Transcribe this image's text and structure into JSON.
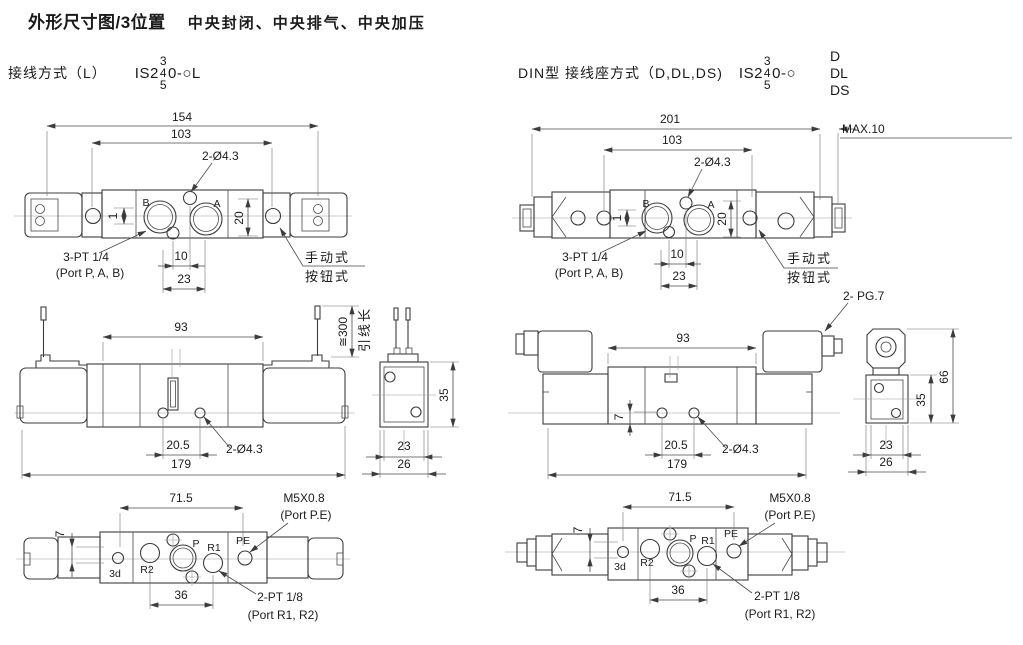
{
  "header": {
    "title": "外形尺寸图/3位置",
    "subtitle": "中央封闭、中央排气、中央加压"
  },
  "variant_left": {
    "label": "接线方式（L）",
    "model_prefix": "IS2",
    "stack_top": "3",
    "stack_mid": "4",
    "stack_bottom": "5",
    "model_suffix": "0-○L"
  },
  "variant_right": {
    "label": "DIN型 接线座方式（D,DL,DS)",
    "model_prefix": "IS2",
    "stack_top": "3",
    "stack_mid": "4",
    "stack_bottom": "5",
    "model_suffix": "0-○",
    "option_top": "D",
    "option_mid": "DL",
    "option_bottom": "DS"
  },
  "top_left": {
    "dim_overall": "154",
    "dim_mount": "103",
    "hole_note": "2-Ø4.3",
    "port_b": "B",
    "port_a": "A",
    "dim_height": "20",
    "dim_offset": "1",
    "dim_hole_pitch": "10",
    "dim_port_pitch": "23",
    "thread_note": "3-PT 1/4",
    "thread_ports": "(Port P, A, B)",
    "manual_line1": "手动式",
    "manual_line2": "按钮式"
  },
  "top_right": {
    "dim_overall": "201",
    "dim_max": "MAX.10",
    "dim_mount": "103",
    "hole_note": "2-Ø4.3",
    "port_b": "B",
    "port_a": "A",
    "dim_height": "20",
    "dim_offset": "1",
    "dim_hole_pitch": "10",
    "dim_port_pitch": "23",
    "thread_note": "3-PT 1/4",
    "thread_ports": "(Port P, A, B)",
    "manual_line1": "手动式",
    "manual_line2": "按钮式"
  },
  "mid_left": {
    "dim_body": "93",
    "wire_length": "≅300",
    "wire_label": "引线长",
    "dim_hole_pitch": "20.5",
    "hole_note": "2-Ø4.3",
    "dim_overall": "179",
    "side": {
      "dim_height": "35",
      "dim_inner_width": "23",
      "dim_width": "26"
    }
  },
  "mid_right": {
    "pg_note": "2- PG.7",
    "dim_body": "93",
    "dim_offset": "7",
    "dim_hole_pitch": "20.5",
    "hole_note": "2-Ø4.3",
    "dim_overall": "179",
    "side": {
      "dim_total_height": "66",
      "dim_height": "35",
      "dim_inner_width": "23",
      "dim_width": "26"
    }
  },
  "bottom_left": {
    "dim_pe_pitch": "71.5",
    "pe_thread": "M5X0.8",
    "pe_port": "(Port P.E)",
    "dim_offset": "7",
    "label_3d": "3d",
    "label_r2": "R2",
    "label_p": "P",
    "label_r1": "R1",
    "label_pe": "PE",
    "dim_exhaust_pitch": "36",
    "exhaust_thread": "2-PT 1/8",
    "exhaust_ports": "(Port R1, R2)"
  },
  "bottom_right": {
    "dim_pe_pitch": "71.5",
    "pe_thread": "M5X0.8",
    "pe_port": "(Port P.E)",
    "dim_offset": "7",
    "label_3d": "3d",
    "label_r2": "R2",
    "label_p": "P",
    "label_r1": "R1",
    "label_pe": "PE",
    "dim_exhaust_pitch": "36",
    "exhaust_thread": "2-PT 1/8",
    "exhaust_ports": "(Port R1, R2)"
  }
}
